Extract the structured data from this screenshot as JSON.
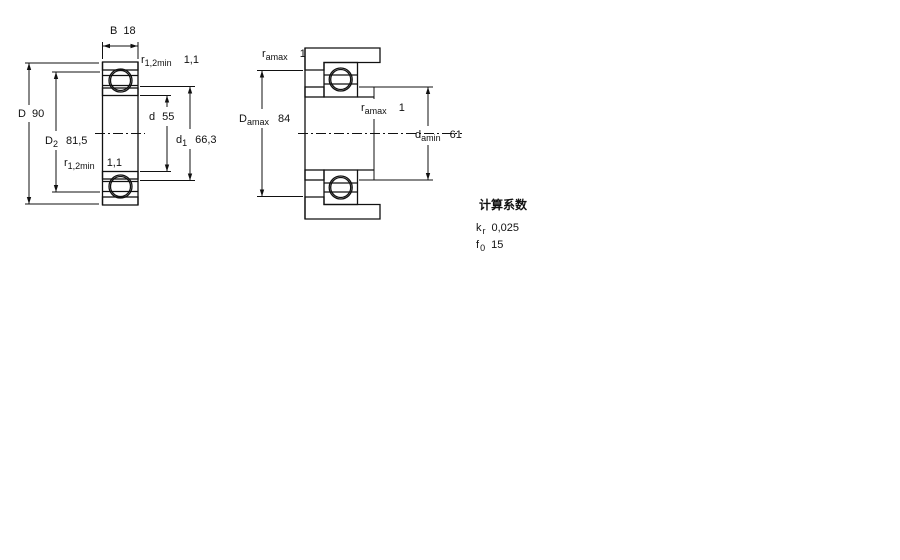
{
  "figure_left": {
    "name": "bearing cross-section",
    "dim_B": {
      "label": "B",
      "value": "18"
    },
    "dim_D": {
      "label": "D",
      "value": "90"
    },
    "dim_D2": {
      "label": "D",
      "sub": "2",
      "value": "81,5"
    },
    "dim_d": {
      "label": "d",
      "value": "55"
    },
    "dim_d1": {
      "label": "d",
      "sub": "1",
      "value": "66,3"
    },
    "dim_r_top": {
      "label": "r",
      "sub": "1,2min",
      "value": "1,1"
    },
    "dim_r_bot": {
      "label": "r",
      "sub": "1,2min",
      "value": "1,1"
    }
  },
  "figure_right": {
    "name": "abutment mounting drawing",
    "dim_ra_top": {
      "label": "r",
      "sub": "amax",
      "value": "1"
    },
    "dim_Damax": {
      "label": "D",
      "sub": "amax",
      "value": "84"
    },
    "dim_ra_mid": {
      "label": "r",
      "sub": "amax",
      "value": "1"
    },
    "dim_damin": {
      "label": "d",
      "sub": "amin",
      "value": "61"
    }
  },
  "calculation_factors": {
    "title": "计算系数",
    "kr": {
      "label": "k",
      "sub": "r",
      "value": "0,025"
    },
    "f0": {
      "label": "f",
      "sub": "0",
      "value": "15"
    }
  },
  "colors": {
    "section_fill_blue": "#b3cfe4",
    "section_dot_blue": "#7ba4c6",
    "line_color": "#111111",
    "background": "#ffffff"
  }
}
